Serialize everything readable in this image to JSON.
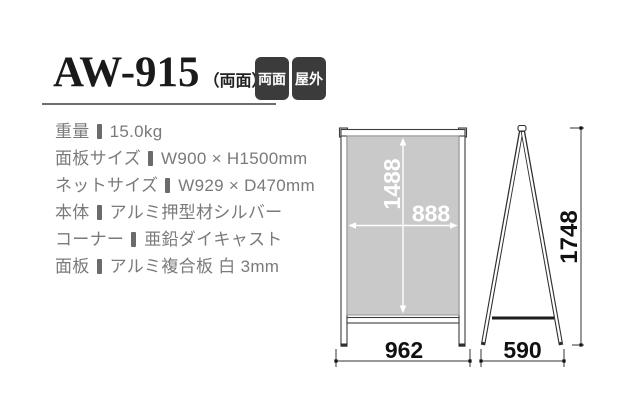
{
  "header": {
    "product_code": "AW-915",
    "product_code_note": "（両面）",
    "badges": [
      {
        "label": "両面"
      },
      {
        "label": "屋外"
      }
    ]
  },
  "specs": {
    "items": [
      {
        "label": "重量",
        "value": "15.0kg"
      },
      {
        "label": "面板サイズ",
        "value": "W900 × H1500mm"
      },
      {
        "label": "ネットサイズ",
        "value": "W929 × D470mm"
      },
      {
        "label": "本体",
        "value": "アルミ押型材シルバー"
      },
      {
        "label": "コーナー",
        "value": "亜鉛ダイキャスト"
      },
      {
        "label": "面板",
        "value": "アルミ複合板 白 3mm"
      }
    ]
  },
  "diagram": {
    "front_view": {
      "inner_height_mm": "1488",
      "inner_width_mm": "888",
      "base_width_mm": "962"
    },
    "side_view": {
      "total_height_mm": "1748",
      "base_depth_mm": "590"
    }
  },
  "colors": {
    "badge_background": "#3b3b3b",
    "badge_text": "#ffffff",
    "panel_fill": "#c9c9c9",
    "frame_stroke": "#3d3d3d",
    "spec_text": "#7a7a7a",
    "title_text": "#1a1a1a",
    "dimension_text_dark": "#111111",
    "dimension_text_light": "#ffffff"
  }
}
